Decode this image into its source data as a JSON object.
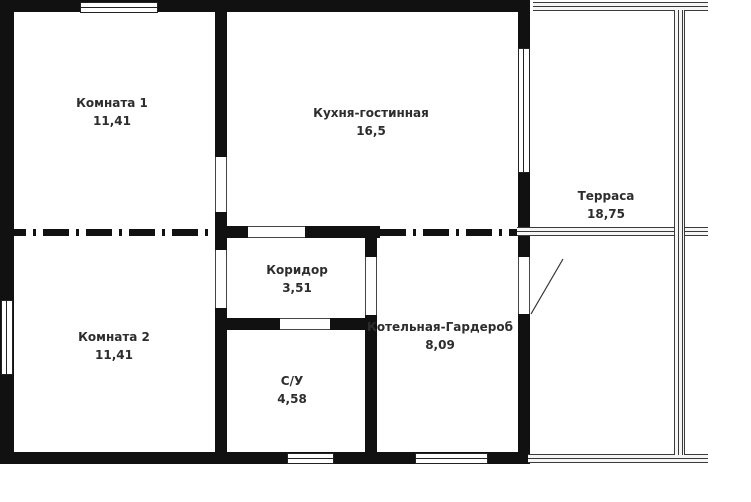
{
  "plan": {
    "type": "floor-plan",
    "units_note": "",
    "rooms": [
      {
        "name": "Комната 1",
        "area": "11,41"
      },
      {
        "name": "Кухня-гостинная",
        "area": "16,5"
      },
      {
        "name": "Терраса",
        "area": "18,75"
      },
      {
        "name": "Комната 2",
        "area": "11,41"
      },
      {
        "name": "Коридор",
        "area": "3,51"
      },
      {
        "name": "С/У",
        "area": "4,58"
      },
      {
        "name": "Котельная-Гардероб",
        "area": "8,09"
      }
    ],
    "colors": {
      "wall": "#111111",
      "background": "#ffffff",
      "label": "#2d2d2d"
    }
  }
}
